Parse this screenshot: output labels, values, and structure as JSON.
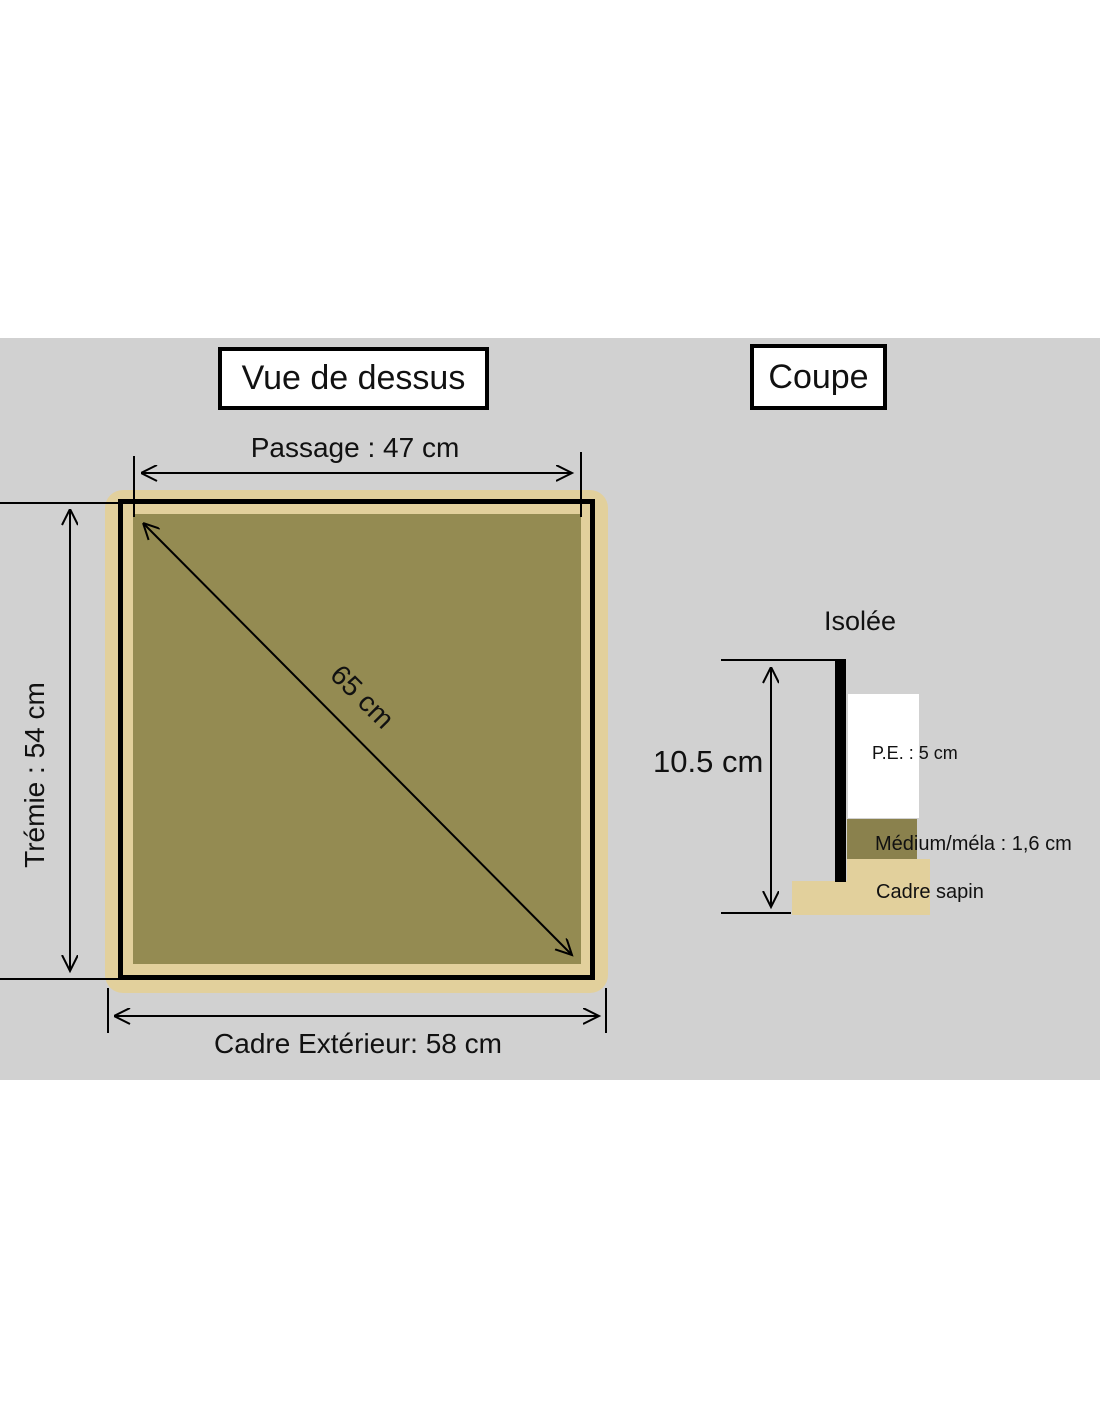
{
  "colors": {
    "band": "#d1d1d1",
    "tan": "#e2d09c",
    "olive": "#948b52",
    "olive_dark": "#8a814d"
  },
  "titles": {
    "top_view": "Vue de dessus",
    "section": "Coupe"
  },
  "top_view": {
    "passage_label": "Passage : 47 cm",
    "tremie_label": "Trémie : 54 cm",
    "diagonal_label": "65 cm",
    "outer_frame_label": "Cadre Extérieur: 58 cm"
  },
  "section": {
    "insulated_label": "Isolée",
    "height_label": "10.5 cm",
    "pe_label": "P.E. : 5 cm",
    "medium_label": "Médium/méla : 1,6 cm",
    "frame_label": "Cadre sapin"
  }
}
